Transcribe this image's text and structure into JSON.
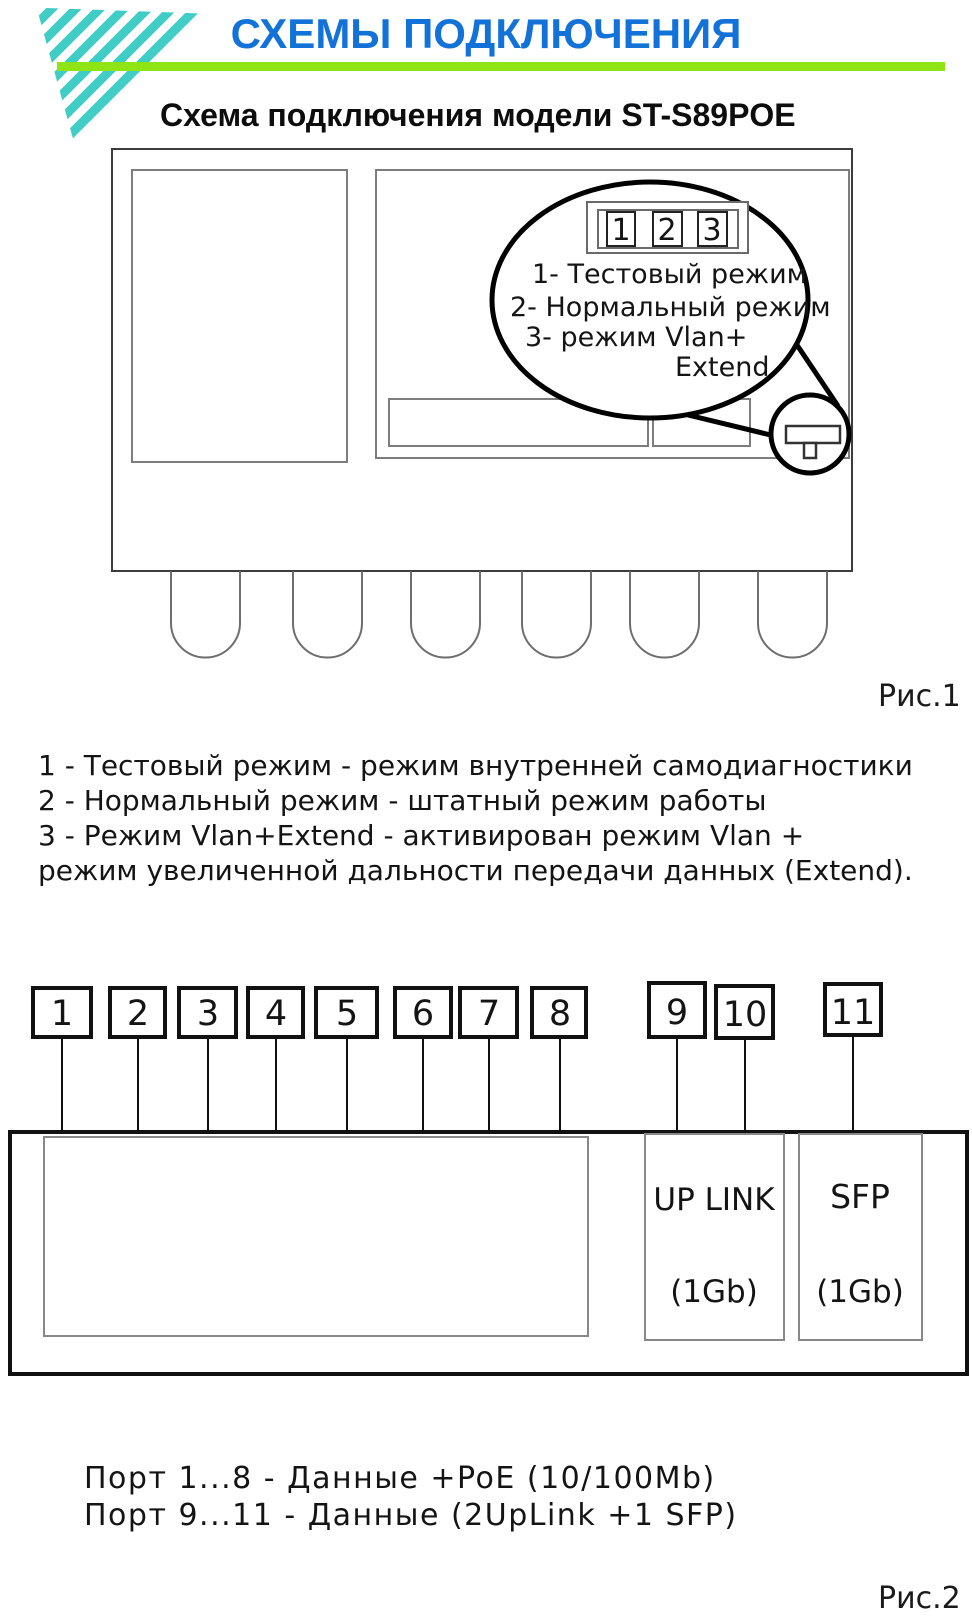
{
  "header": {
    "title": "СХЕМЫ ПОДКЛЮЧЕНИЯ",
    "subtitle": "Схема подключения модели ST-S89POE",
    "colors": {
      "title_blue": "#1272d8",
      "rule_green": "#8ee414",
      "logo_teal": "#40cdc6"
    }
  },
  "fig1": {
    "caption": "Рис.1",
    "dip_switch": {
      "digits": [
        "1",
        "2",
        "3"
      ]
    },
    "callout": {
      "lines": [
        "1- Тестовый режим",
        "2- Нормальный режим",
        "3- режим Vlan+",
        "Extend"
      ]
    }
  },
  "mode_notes": {
    "lines": [
      "1 - Тестовый режим - режим внутренней самодиагностики",
      "2 - Нормальный режим - штатный режим работы",
      "3 - Режим Vlan+Extend -  активирован режим Vlan +",
      "режим увеличенной дальности передачи данных (Extend)."
    ]
  },
  "fig2": {
    "caption": "Рис.2",
    "port_labels": [
      "1",
      "2",
      "3",
      "4",
      "5",
      "6",
      "7",
      "8",
      "9",
      "10",
      "11"
    ],
    "uplink_label": {
      "line1": "UP LINK",
      "line2": "(1Gb)"
    },
    "sfp_label": {
      "line1": "SFP",
      "line2": "(1Gb)"
    }
  },
  "ports_note": {
    "lines": [
      "Порт 1...8  - Данные +PoE (10/100Mb)",
      "Порт 9...11  - Данные (2UpLink +1 SFP)"
    ]
  }
}
